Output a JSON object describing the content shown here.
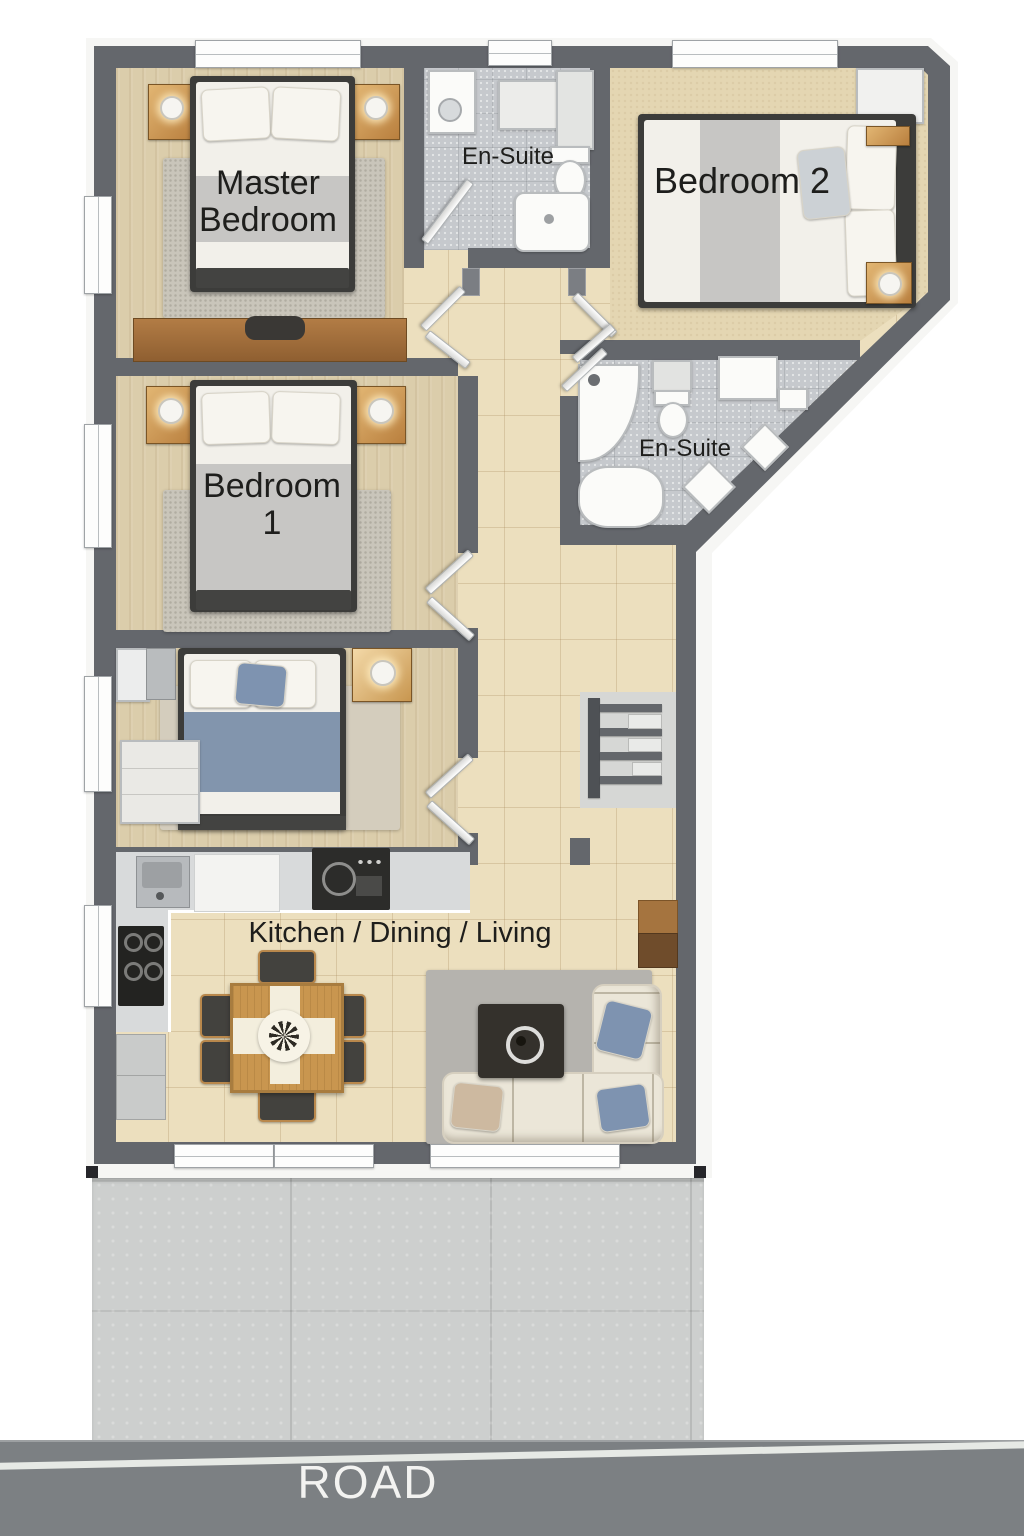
{
  "rooms": {
    "master_bedroom": {
      "label_lines": [
        "Master",
        "Bedroom"
      ]
    },
    "ensuite_top": {
      "label": "En-Suite"
    },
    "bedroom_2": {
      "label": "Bedroom 2"
    },
    "bedroom_1": {
      "label_lines": [
        "Bedroom",
        "1"
      ]
    },
    "ensuite_middle": {
      "label": "En-Suite"
    },
    "kitchen_dining_living": {
      "label": "Kitchen / Dining / Living"
    }
  },
  "road": {
    "label": "ROAD"
  },
  "colors": {
    "wall": "#64676c",
    "trim": "#f6f6f4",
    "tile": "#ecdfbe",
    "carpet": "#dbcdab",
    "carpet_b2": "#e4d6b2",
    "mosaic": "#c6c9cd",
    "wood": "#c9964f",
    "wood_dark": "#9a6a3d",
    "bed_frame": "#3c3c3a",
    "mattress": "#f2f0ea",
    "duvet_gray": "#c7c6c4",
    "duvet_blue": "#8295ad",
    "rug": "#c9c5ba",
    "rug_living": "#b5b3ae",
    "counter": "#d8dadb",
    "appliance": "#2c2c2a",
    "sofa": "#ebe6d8",
    "pillow_blue": "#7e93b0",
    "pillow_tan": "#cdb9a0",
    "fixture": "#fbfbf9",
    "nook_floor": "#d6d7d5",
    "driveway": "#cdcfce",
    "road": "#7c8083",
    "road_line": "#eceeea",
    "label_text": "#1e1e1c",
    "road_text": "#f3f3f1"
  }
}
